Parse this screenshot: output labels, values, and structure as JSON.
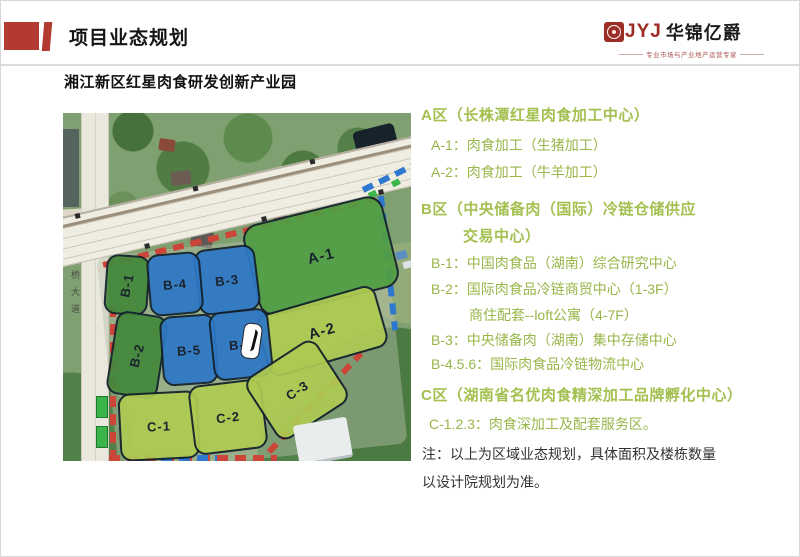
{
  "header": {
    "title": "项目业态规划",
    "subtitle": "湘江新区红星肉食研发创新产业园",
    "accent_color": "#b23a30",
    "logo": {
      "letters": "JYJ",
      "seal_letter": "H",
      "name": "华锦亿爵",
      "tagline": "专业市场与产业地产运营专家",
      "letters_color": "#9c2d24"
    }
  },
  "sections": {
    "a": {
      "heading": "A区（长株潭红星肉食加工中心）",
      "item1": "A-1：肉食加工（生猪加工）",
      "item2": "A-2：肉食加工（牛羊加工）"
    },
    "b": {
      "heading1": "B区（中央储备肉（国际）冷链仓储供应",
      "heading2": "交易中心）",
      "item1": "B-1：中国肉食品（湖南）综合研究中心",
      "item2": "B-2：国际肉食品冷链商贸中心（1-3F）",
      "item2b": "商住配套--loft公寓（4-7F）",
      "item3": "B-3：中央储备肉（湖南）集中存储中心",
      "item4": "B-4.5.6：国际肉食品冷链物流中心"
    },
    "c": {
      "heading": "C区（湖南省名优肉食精深加工品牌孵化中心）",
      "item1": "C-1.2.3：肉食深加工及配套服务区。"
    },
    "note1": "注：以上为区域业态规划，具体面积及楼栋数量",
    "note2": "以设计院规划为准。",
    "heading_color": "#a4c050",
    "item_color": "#98b64a"
  },
  "map": {
    "road_label": "黄桥大道",
    "zones": [
      {
        "label": "A-1",
        "color": "#519e44"
      },
      {
        "label": "A-2",
        "color": "#aeca52"
      },
      {
        "label": "B-1",
        "color": "#44883c"
      },
      {
        "label": "B-2",
        "color": "#44883c"
      },
      {
        "label": "B-3",
        "color": "#2e78c6"
      },
      {
        "label": "B-4",
        "color": "#2e78c6"
      },
      {
        "label": "B-5",
        "color": "#2e78c6"
      },
      {
        "label": "B-6",
        "color": "#2e78c6"
      },
      {
        "label": "C-1",
        "color": "#aeca52"
      },
      {
        "label": "C-2",
        "color": "#aeca52"
      },
      {
        "label": "C-3",
        "color": "#aeca52"
      }
    ],
    "boundary_red": "#cc4538",
    "boundary_blue": "#2e78d0"
  }
}
